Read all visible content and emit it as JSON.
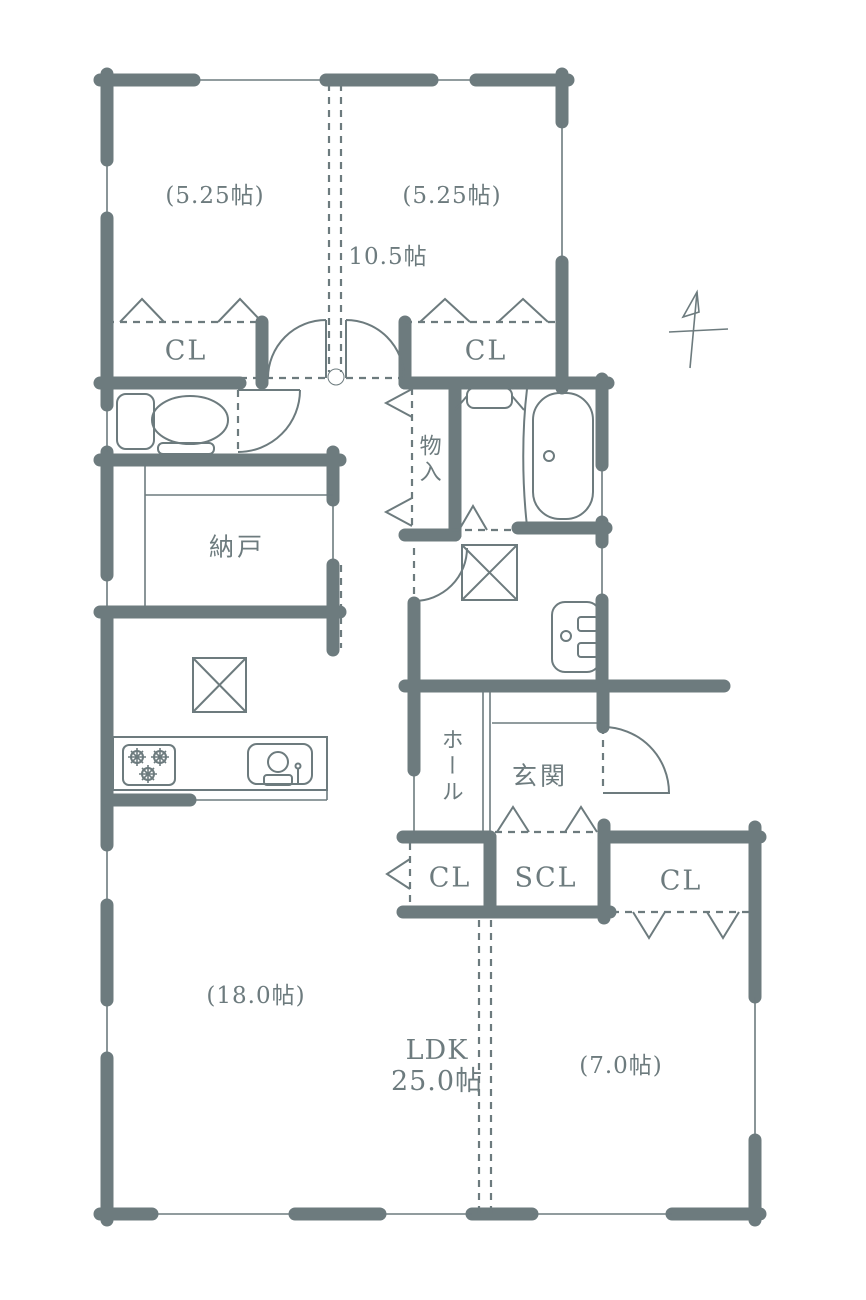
{
  "colors": {
    "background": "#ffffff",
    "ink": "#6d7b7e"
  },
  "compass": {
    "name": "north-arrow"
  },
  "rooms": {
    "bedroom_left": {
      "area_label": "(5.25帖)"
    },
    "bedroom_right": {
      "area_label": "(5.25帖)"
    },
    "bedrooms_combined": {
      "area_label": "10.5帖"
    },
    "bedroom_left_closet": {
      "label": "CL"
    },
    "bedroom_right_closet": {
      "label": "CL"
    },
    "corridor_storage": {
      "label": "物入"
    },
    "storage_room": {
      "label": "納戸"
    },
    "hall": {
      "label": "ホール"
    },
    "entrance": {
      "label": "玄関"
    },
    "hall_closet": {
      "label": "CL"
    },
    "shoe_closet": {
      "label": "SCL"
    },
    "bedroom3_closet": {
      "label": "CL"
    },
    "living_left": {
      "area_label": "(18.0帖)"
    },
    "ldk": {
      "label": "LDK",
      "area_label": "25.0帖"
    },
    "bedroom3": {
      "area_label": "(7.0帖)"
    }
  }
}
